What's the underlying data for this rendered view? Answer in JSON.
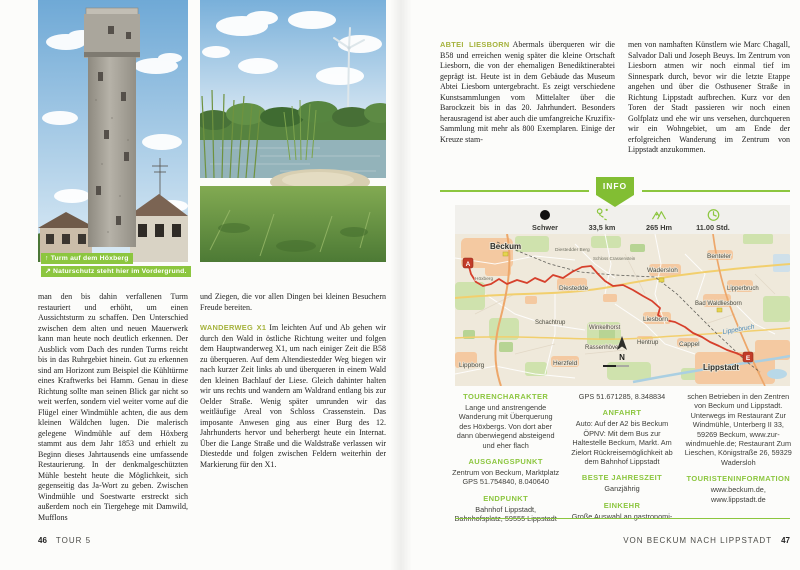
{
  "colors": {
    "accent_green": "#8cc63f",
    "runin_heading_green": "#a5b23c",
    "badge_green": "#82be33",
    "route_red": "#d6402c"
  },
  "left_page": {
    "captions": [
      {
        "icon": "↑",
        "text": "Turm auf dem Höxberg"
      },
      {
        "icon": "↗",
        "text": "Naturschutz steht hier im Vordergrund."
      }
    ],
    "column1": {
      "text": "man den bis dahin verfallenen Turm restauriert und erhöht, um einen Aussichtsturm zu schaffen. Den Unterschied zwischen dem alten und neuen Mauerwerk kann man heute noch deutlich erkennen. Der Ausblick vom Dach des runden Turms reicht bis in das Ruhrgebiet hinein. Gut zu erkennen sind am Horizont zum Beispiel die Kühltürme eines Kraftwerks bei Hamm. Genau in diese Richtung sollte man seinen Blick gar nicht so weit werfen, sondern viel weiter vorne auf die Flügel einer Windmühle achten, die aus dem kleinen Wäldchen lugen. Die malerisch gelegene Windmühle auf dem Höxberg stammt aus dem Jahr 1853 und erhielt zu Beginn dieses Jahrtausends eine umfassende Restaurierung. In der denkmalgeschützten Mühle besteht heute die Möglichkeit, sich gegenseitig das Ja-Wort zu geben. Zwischen Windmühle und Soestwarte erstreckt sich außerdem noch ein Tiergehege mit Damwild, Mufflons"
    },
    "column2": {
      "para1": "und Ziegen, die vor allen Dingen bei kleinen Besuchern Freude bereiten.",
      "heading": "WANDERWEG X1",
      "para2": "Im leichten Auf und Ab gehen wir durch den Wald in östliche Richtung weiter und folgen dem Hauptwanderweg X1, um nach einiger Zeit die B58 zu überqueren. Auf dem Altendiestedder Weg biegen wir nach kurzer Zeit links ab und überqueren in einem Wald den kleinen Bachlauf der Liese. Gleich dahinter halten wir uns rechts und wandern am Waldrand entlang bis zur Oelder Straße. Wenig später umrunden wir das weitläufige Areal von Schloss Crassenstein. Das imposante Anwesen ging aus einer Burg des 12. Jahrhunderts hervor und beherbergt heute ein Internat. Über die Lange Straße und die Waldstraße verlassen wir Diestedde und folgen zwischen Feldern weiterhin der Markierung für den X1."
    },
    "footer": {
      "page": "46",
      "label": "TOUR 5"
    }
  },
  "right_page": {
    "column1": {
      "heading": "ABTEI LIESBORN",
      "text": "Abermals überqueren wir die B58 und erreichen wenig später die kleine Ortschaft Liesborn, die von der ehemaligen Benediktinerabtei geprägt ist. Heute ist in dem Gebäude das Museum Abtei Liesborn untergebracht. Es zeigt verschiedene Kunstsammlungen vom Mittelalter über die Barockzeit bis in das 20. Jahrhundert. Besonders herausragend ist aber auch die umfangreiche Kruzifix-Sammlung mit mehr als 800 Exemplaren. Einige der Kreuze stam-"
    },
    "column2": {
      "text": "men von namhaften Künstlern wie Marc Chagall, Salvador Dali und Joseph Beuys. Im Zentrum von Liesborn atmen wir noch einmal tief im Sinnespark durch, bevor wir die letzte Etappe angehen und über die Osthusener Straße in Richtung Lippstadt aufbrechen. Kurz vor den Toren der Stadt passieren wir noch einen Golfplatz und ehe wir uns versehen, durchqueren wir ein Wohngebiet, um am Ende der erfolgreichen Wanderung im Zentrum von Lippstadt anzukommen."
    },
    "info_badge": "INFO",
    "stats": [
      {
        "icon": "difficulty-dot",
        "value": "Schwer"
      },
      {
        "icon": "route",
        "value": "33,5 km"
      },
      {
        "icon": "mountains",
        "value": "265 Hm"
      },
      {
        "icon": "clock",
        "value": "11.00 Std."
      }
    ],
    "map": {
      "marker_start": "A",
      "marker_end": "E",
      "compass": "N",
      "labels": {
        "beckum": "Beckum",
        "hoexberg": "Höxberg",
        "diestedder_berg": "Diestedder Berg",
        "schloss": "Schloss Crassenstein",
        "diestedde": "Diestedde",
        "wadersloh": "Wadersloh",
        "benteler": "Benteler",
        "lipperbruch": "Lipperbruch",
        "bad_waldliesborn": "Bad Waldliesborn",
        "liesborn": "Liesborn",
        "hentrup": "Hentrup",
        "cappel": "Cappel",
        "lippebruch": "Lippebruch",
        "lippstadt": "Lippstadt",
        "herzfeld": "Herzfeld",
        "lippborg": "Lippborg",
        "schachtrup": "Schachtrup",
        "winkelhorst": "Winkelhorst",
        "rassenhoevel": "Rassenhövel"
      }
    },
    "details": {
      "col1": [
        {
          "heading": "TOURENCHARAKTER",
          "text": "Lange und anstrengende Wanderung mit Überquerung des Höxbergs. Von dort aber dann überwiegend absteigend und eher flach"
        },
        {
          "heading": "AUSGANGSPUNKT",
          "text": "Zentrum von Beckum, Marktplatz GPS 51.754840, 8.040640"
        },
        {
          "heading": "ENDPUNKT",
          "text": "Bahnhof Lippstadt, Bahnhofsplatz, 59555 Lippstadt"
        }
      ],
      "col2": [
        {
          "heading": "",
          "text": "GPS 51.671285, 8.348834"
        },
        {
          "heading": "ANFAHRT",
          "text": "Auto: Auf der A2 bis Beckum ÖPNV: Mit dem Bus zur Haltestelle Beckum, Markt. Am Zielort Rückreisemöglichkeit ab dem Bahnhof Lippstadt"
        },
        {
          "heading": "BESTE JAHRESZEIT",
          "text": "Ganzjährig"
        },
        {
          "heading": "EINKEHR",
          "text": "Große Auswahl an gastronomi-"
        }
      ],
      "col3": [
        {
          "heading": "",
          "text": "schen Betrieben in den Zentren von Beckum und Lippstadt. Unterwegs im Restaurant Zur Windmühle, Unterberg II 33, 59269 Beckum, www.zur-windmuehle.de; Restaurant Zum Lieschen, Königstraße 26, 59329 Wadersloh"
        },
        {
          "heading": "TOURISTENINFORMATION",
          "text": "www.beckum.de, www.lippstadt.de"
        }
      ]
    },
    "footer": {
      "label": "VON BECKUM NACH LIPPSTADT",
      "page": "47"
    }
  }
}
